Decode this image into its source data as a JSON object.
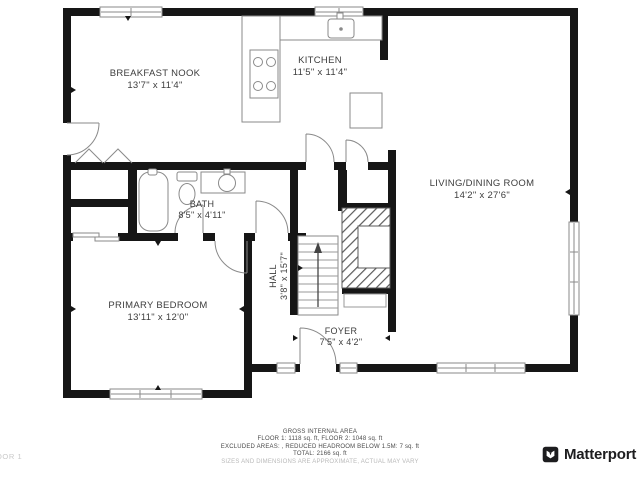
{
  "plan": {
    "floor_label": "FLOOR 1",
    "rooms": [
      {
        "id": "breakfast-nook",
        "name": "BREAKFAST NOOK",
        "dims": "13'7\" x 11'4\""
      },
      {
        "id": "kitchen",
        "name": "KITCHEN",
        "dims": "11'5\" x 11'4\""
      },
      {
        "id": "living-dining",
        "name": "LIVING/DINING ROOM",
        "dims": "14'2\" x 27'6\""
      },
      {
        "id": "bath",
        "name": "BATH",
        "dims": "8'5\" x 4'11\""
      },
      {
        "id": "hall",
        "name": "HALL",
        "dims": "3'8\" x 15'7\""
      },
      {
        "id": "primary-bedroom",
        "name": "PRIMARY BEDROOM",
        "dims": "13'11\" x 12'0\""
      },
      {
        "id": "foyer",
        "name": "FOYER",
        "dims": "7'5\" x 4'2\""
      }
    ],
    "fixtures": [
      "stove-icon",
      "kitchen-sink-icon",
      "fridge-icon",
      "bathtub-icon",
      "toilet-icon",
      "vanity-sink-icon",
      "stairs-up-icon",
      "fireplace-icon"
    ]
  },
  "footer": {
    "area_summary": {
      "title": "GROSS INTERNAL AREA",
      "line1": "FLOOR 1: 1118 sq. ft, FLOOR 2: 1048 sq. ft",
      "line2": "EXCLUDED AREAS: , REDUCED HEADROOM BELOW 1.5M: 7 sq. ft",
      "line3": "TOTAL: 2166 sq. ft",
      "disclaimer": "SIZES AND DIMENSIONS ARE APPROXIMATE, ACTUAL MAY VARY"
    },
    "floor_tag": "FLOOR 1",
    "brand": "Matterport",
    "brand_icon": "matterport-logo-icon"
  },
  "colors": {
    "wall": "#161616",
    "fixture_line": "#8a8a8a",
    "label": "#3d3d3d",
    "muted": "#b9b9b9"
  }
}
